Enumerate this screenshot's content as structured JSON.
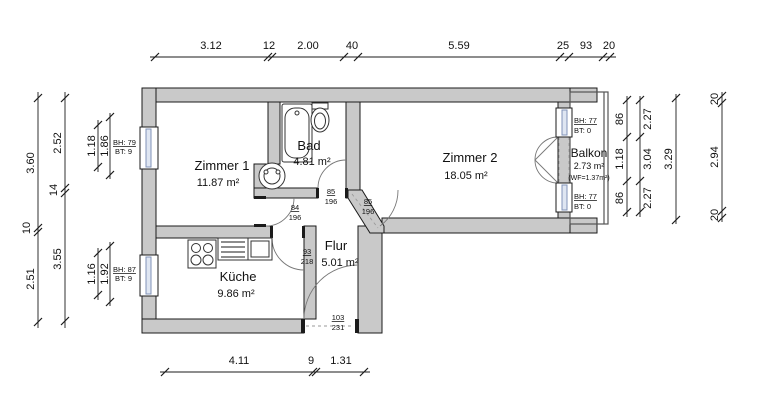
{
  "plan": {
    "rooms": [
      {
        "name": "Zimmer 1",
        "area": "11.87 m²"
      },
      {
        "name": "Bad",
        "area": "4.81 m²"
      },
      {
        "name": "Zimmer 2",
        "area": "18.05 m²"
      },
      {
        "name": "Balkon",
        "area": "2.73 m²",
        "note": "(WF=1.37m²)"
      },
      {
        "name": "Küche",
        "area": "9.86 m²"
      },
      {
        "name": "Flur",
        "area": "5.01 m²"
      }
    ],
    "doors": [
      {
        "id": "bad-door",
        "width": "85",
        "height": "196"
      },
      {
        "id": "zimmer1-door",
        "width": "84",
        "height": "196"
      },
      {
        "id": "zimmer2-door",
        "width": "85",
        "height": "196"
      },
      {
        "id": "kueche-door",
        "width": "93",
        "height": "218"
      },
      {
        "id": "entrance-door",
        "width": "103",
        "height": "231"
      }
    ],
    "windows": [
      {
        "id": "zimmer1-window",
        "bh": "BH: 79",
        "bt": "BT: 9"
      },
      {
        "id": "kueche-window",
        "bh": "BH: 87",
        "bt": "BT: 9"
      },
      {
        "id": "balkon-window-top",
        "bh": "BH: 77",
        "bt": "BT: 0"
      },
      {
        "id": "balkon-window-bottom",
        "bh": "BH: 77",
        "bt": "BT: 0"
      }
    ],
    "dimensions": {
      "top": [
        "3.12",
        "12",
        "2.00",
        "40",
        "5.59",
        "25",
        "93",
        "20"
      ],
      "bottom": [
        "4.11",
        "9",
        "1.31"
      ],
      "left_outer": [
        "3.60",
        "10",
        "2.51"
      ],
      "left_inner": [
        "2.52",
        "14",
        "3.55"
      ],
      "left_window_upper": [
        "1.18",
        "1.86"
      ],
      "left_window_lower": [
        "1.16",
        "1.92"
      ],
      "right_opening": [
        "86",
        "1.18",
        "86"
      ],
      "right_room": [
        "2.27",
        "3.04",
        "2.27"
      ],
      "right_total_inner": "3.29",
      "right_outer": [
        "20",
        "2.94",
        "20"
      ]
    },
    "colors": {
      "wall": "#c9c9c9",
      "outline": "#1b1b1b",
      "glazing": "#8093b8",
      "background": "#ffffff"
    }
  }
}
